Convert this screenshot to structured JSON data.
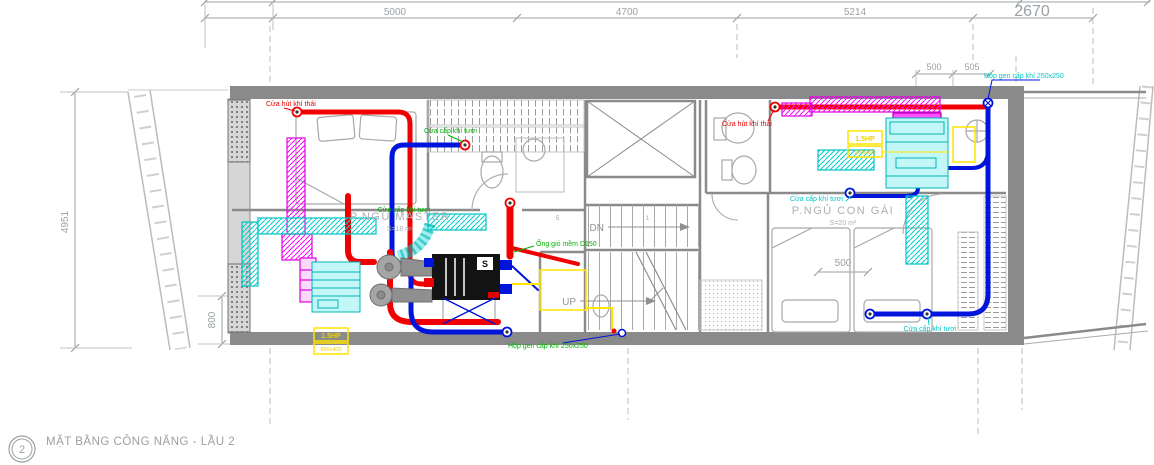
{
  "drawing": {
    "title": {
      "ref_number": "2",
      "text": "MẶT BẰNG CÔNG NĂNG - LẦU 2"
    },
    "dimensions": {
      "top": [
        "5000",
        "4700",
        "5214",
        "2670"
      ],
      "top_small": [
        "500",
        "505"
      ],
      "left": [
        "4951",
        "800"
      ],
      "interior": [
        "500"
      ]
    },
    "rooms": [
      {
        "name": "P.NGỦ MASTER",
        "area": "S=18 m²"
      },
      {
        "name": "P.NGỦ CON GÁI",
        "area": "S=20 m²"
      }
    ],
    "stairs": {
      "down_label": "DN",
      "up_label": "UP",
      "step_numbers": [
        "5",
        "1"
      ]
    },
    "hvac_labels": {
      "exhaust_door_left": "Cửa hút khí thải",
      "fresh_air_door_left": "Cửa cấp khí tươi",
      "fresh_air_door_master": "Cửa cấp khí tươi",
      "flex_duct": "Ống gió mềm D150",
      "supply_shaft_bottom": "Hộp gen cấp khí 250x250",
      "exhaust_door_right": "Cửa hút khí thải",
      "fresh_air_door_girl": "Cửa cấp khí tươi",
      "fresh_air_door_bottom_right": "Cửa cấp khí tươi",
      "supply_shaft_top": "Hộp gen cấp khí 250x250"
    },
    "equipment": {
      "ahu_mark": "S",
      "tag_left": {
        "line1": "1.5HP",
        "line2": "600x400"
      },
      "tag_right": {
        "line1": "1.5HP",
        "line2": "600x400"
      }
    },
    "colors": {
      "red": "#ff0000",
      "blue": "#0014dc",
      "cyan": "#00d7d7",
      "magenta": "#ff00ff",
      "yellow": "#ffe400",
      "green": "#00b400",
      "wall_gray": "#8a8a8a",
      "dim_gray": "#9aa0a4"
    }
  }
}
